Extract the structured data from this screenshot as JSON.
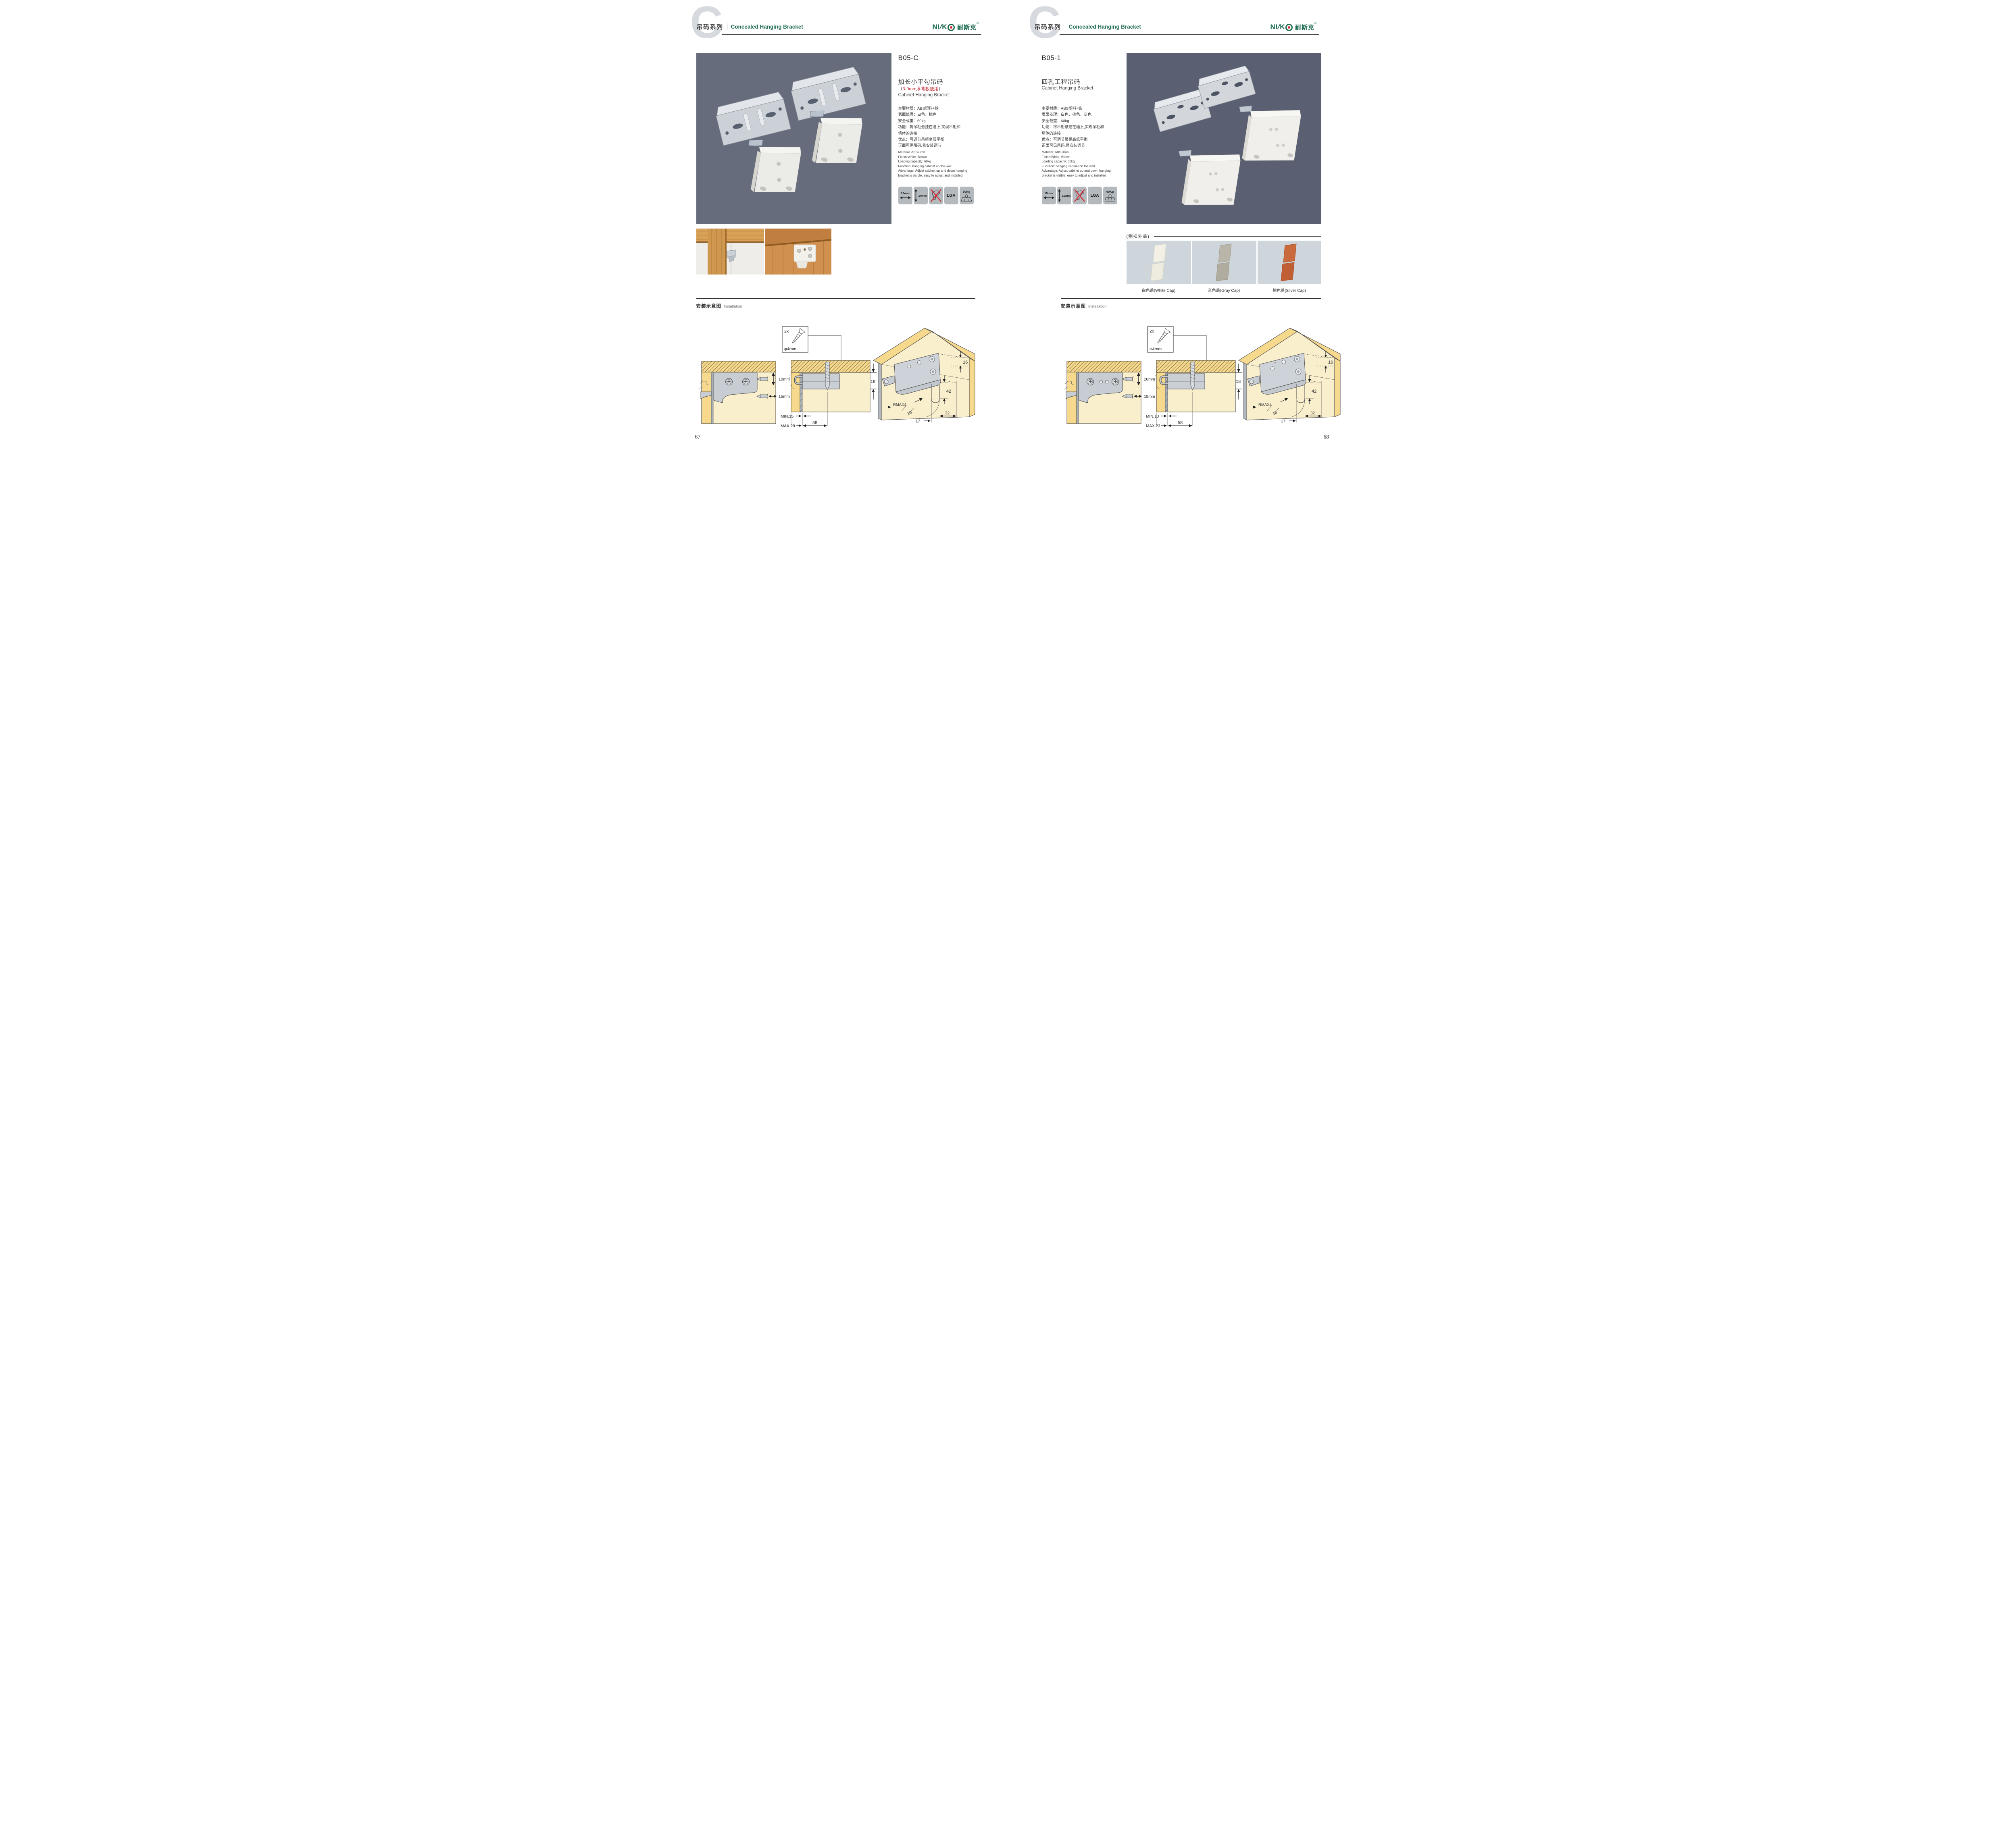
{
  "header": {
    "letter": "C",
    "series_zh": "吊码系列",
    "series_en": "Concealed Hanging Bracket"
  },
  "brand": {
    "latin_ni": "NI",
    "slash": "/",
    "latin_k": "K",
    "cn": "耐斯克",
    "reg": "®"
  },
  "pages": [
    {
      "code": "B05-C",
      "name_zh": "加长小平勾吊码",
      "note_open": "（",
      "note_body": "3-9mm厚背板使用",
      "note_close": "）",
      "name_en": "Cabinet Hanging Bracket",
      "specs_zh": [
        "主要材质：ABS塑料+铁",
        "表面处理：白色、棕色",
        "安全载重：60kg",
        "功能：将吊柜悬挂在墙上,实现吊柜和",
        "墙体的连接",
        "优点：可调节吊柜高低平衡",
        "正面可见吊码,易安装调节"
      ],
      "specs_en": [
        "Material: ABS+Iron",
        "Finish:White, Brown",
        "Loading capacity: 60kg",
        "Function: hanging cabinet on the wall",
        "Advantage: Adjust cabinet up and down hanging",
        "bracket is visible, easy to adjust and installed"
      ],
      "icons": [
        {
          "name": "width-adjust",
          "label": "15mm"
        },
        {
          "name": "height-adjust",
          "label": "10mm"
        },
        {
          "name": "no-drill",
          "label": ""
        },
        {
          "name": "lga-cert",
          "label": "LGA"
        },
        {
          "name": "load-capacity",
          "label": "60Kg"
        }
      ],
      "install": {
        "title_zh": "安装示意图",
        "title_en": "Installation"
      },
      "d1": {
        "v": "10mm",
        "h": "15mm"
      },
      "d2": {
        "qty": "2x",
        "dia": "φ4mm",
        "t": "18",
        "min": "MIN.15",
        "max": "MAX.28",
        "span": "58"
      },
      "d3": {
        "top": "16",
        "h": "42",
        "r": "RMAX4",
        "side": "16",
        "a": "17",
        "b": "32"
      },
      "page_no": "67"
    },
    {
      "code": "B05-1",
      "name_zh": "四孔工程吊码",
      "name_en": "Cabinet Hanging Bracket",
      "specs_zh": [
        "主要材质：ABS塑料+铁",
        "表面处理：白色、棕色、灰色",
        "安全载重：60kg",
        "功能：将吊柜悬挂在墙上,实现吊柜和",
        "墙体的连接",
        "优点：可调节吊柜高低平衡",
        "正面可见吊码,易安装调节"
      ],
      "specs_en": [
        "Material: ABS+Iron",
        "Finish:White, Brown",
        "Loading capacity: 60kg",
        "Function: hanging cabinet on the wall",
        "Advantage: Adjust cabinet up and down hanging",
        "bracket is visible, easy to adjust and installed"
      ],
      "icons": [
        {
          "name": "width-adjust",
          "label": "15mm"
        },
        {
          "name": "height-adjust",
          "label": "10mm"
        },
        {
          "name": "no-drill",
          "label": ""
        },
        {
          "name": "lga-cert",
          "label": "LGA"
        },
        {
          "name": "load-capacity",
          "label": "60Kg"
        }
      ],
      "caps": {
        "title": "(侧扣外盖)",
        "items": [
          "白色盖(White Cap)",
          "灰色盖(Gray Cap)",
          "棕色盖(Silver Cap)"
        ]
      },
      "install": {
        "title_zh": "安装示意图",
        "title_en": "Installation"
      },
      "d1": {
        "v": "10mm",
        "h": "15mm"
      },
      "d2": {
        "qty": "2x",
        "dia": "φ4mm",
        "t": "18",
        "min": "MIN.10",
        "max": "MAX.23",
        "span": "58"
      },
      "d3": {
        "top": "16",
        "h": "42",
        "r": "RMAX4",
        "side": "16",
        "a": "17",
        "b": "32"
      },
      "page_no": "68"
    }
  ]
}
